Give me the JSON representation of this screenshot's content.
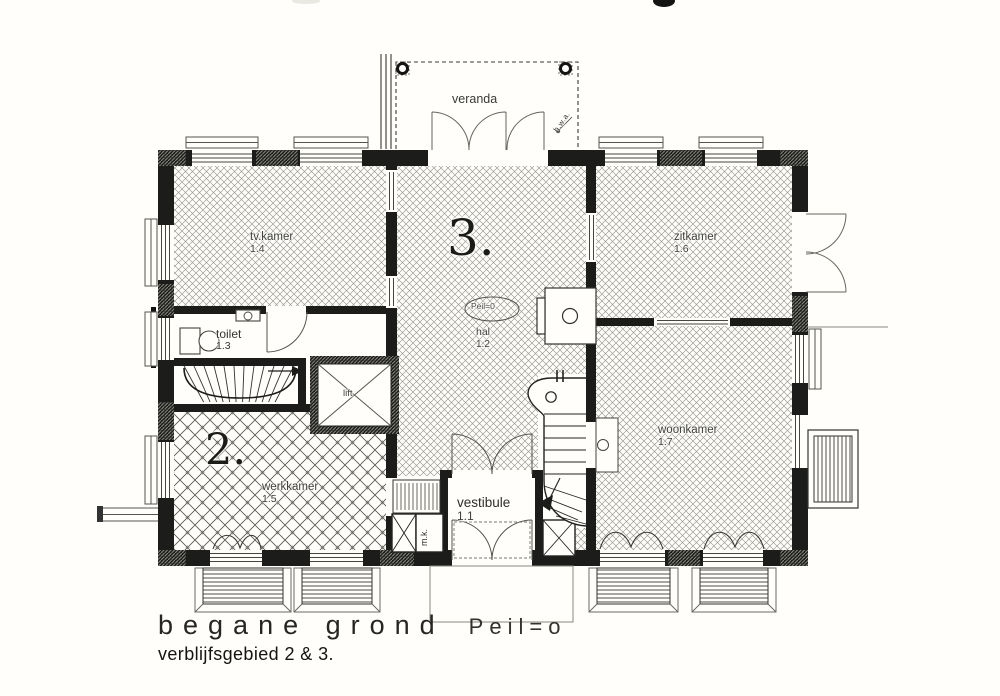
{
  "page": {
    "background": "#fffefb",
    "ink": "#1c1c1a",
    "hatch_fine": "#97978f",
    "hatch_coarse": "#4f4f49"
  },
  "plan": {
    "veranda": "veranda",
    "hwa": "h.w.a.",
    "peil_marker": "Peil=0",
    "lift": "lift",
    "mk": "m.k.",
    "zone2": "2.",
    "zone3": "3.",
    "rooms": {
      "vestibule": {
        "label": "vestibule",
        "number": "1.1"
      },
      "hal": {
        "label": "hal",
        "number": "1.2"
      },
      "toilet": {
        "label": "toilet",
        "number": "1.3"
      },
      "tvkamer": {
        "label": "tv.kamer",
        "number": "1.4"
      },
      "werkkamer": {
        "label": "werkkamer",
        "number": "1.5"
      },
      "zitkamer": {
        "label": "zitkamer",
        "number": "1.6"
      },
      "woonkamer": {
        "label": "woonkamer",
        "number": "1.7"
      }
    }
  },
  "caption": {
    "title": "begane grond",
    "level": "Peil=o",
    "subtitle": "verblijfsgebied 2 & 3."
  }
}
